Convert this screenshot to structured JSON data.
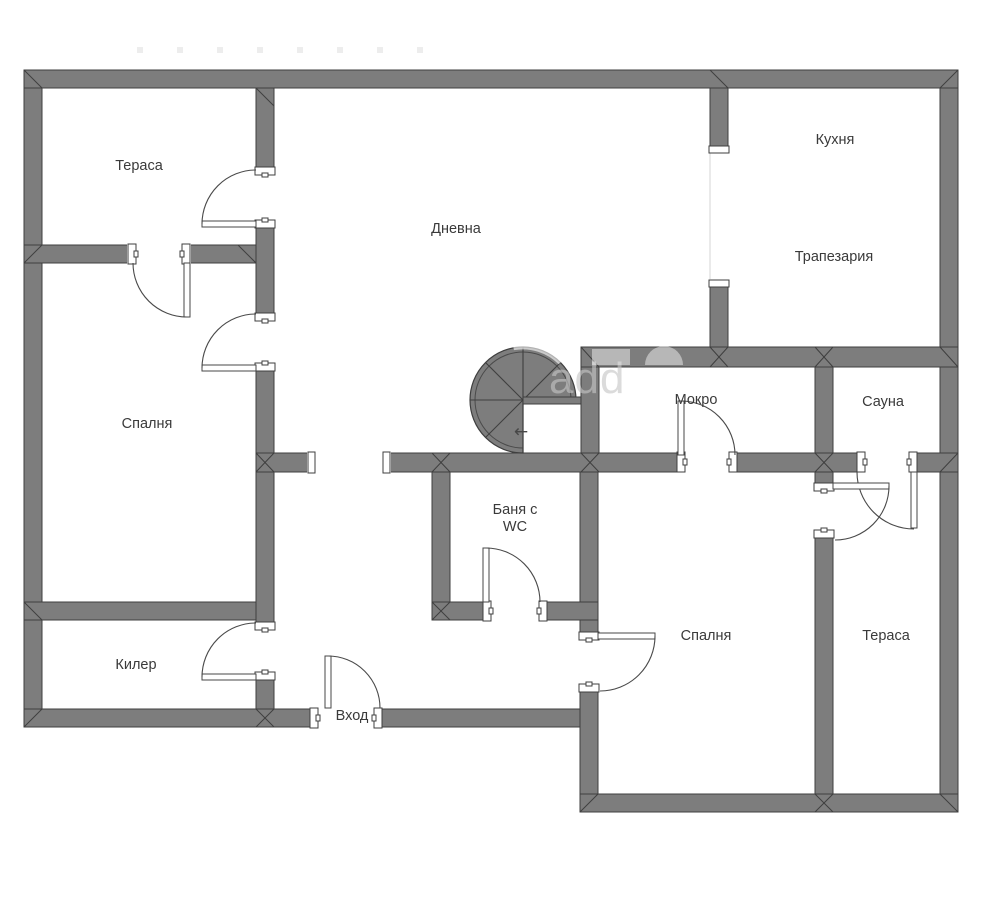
{
  "rooms": {
    "terrace_top_left": {
      "label": "Тераса"
    },
    "living_room": {
      "label": "Дневна"
    },
    "kitchen": {
      "label": "Кухня"
    },
    "dining_room": {
      "label": "Трапезария"
    },
    "bedroom_left": {
      "label": "Спалня"
    },
    "wet_room": {
      "label": "Мокро"
    },
    "sauna": {
      "label": "Сауна"
    },
    "bathroom": {
      "label_line1": "Баня с",
      "label_line2": "WC"
    },
    "closet": {
      "label": "Килер"
    },
    "entrance": {
      "label": "Вход"
    },
    "bedroom_right": {
      "label": "Спалня"
    },
    "terrace_bottom_right": {
      "label": "Тераса"
    }
  },
  "stair": {
    "direction_arrow": "←"
  },
  "watermark": {
    "fragment": "add"
  },
  "colors": {
    "background": "#ffffff",
    "wall_fill": "#7d7d7d",
    "wall_outline": "#3f3f3f",
    "door_line": "#4a4a4a",
    "label_text": "#3a3a3a",
    "watermark": "#c6c6c6"
  }
}
